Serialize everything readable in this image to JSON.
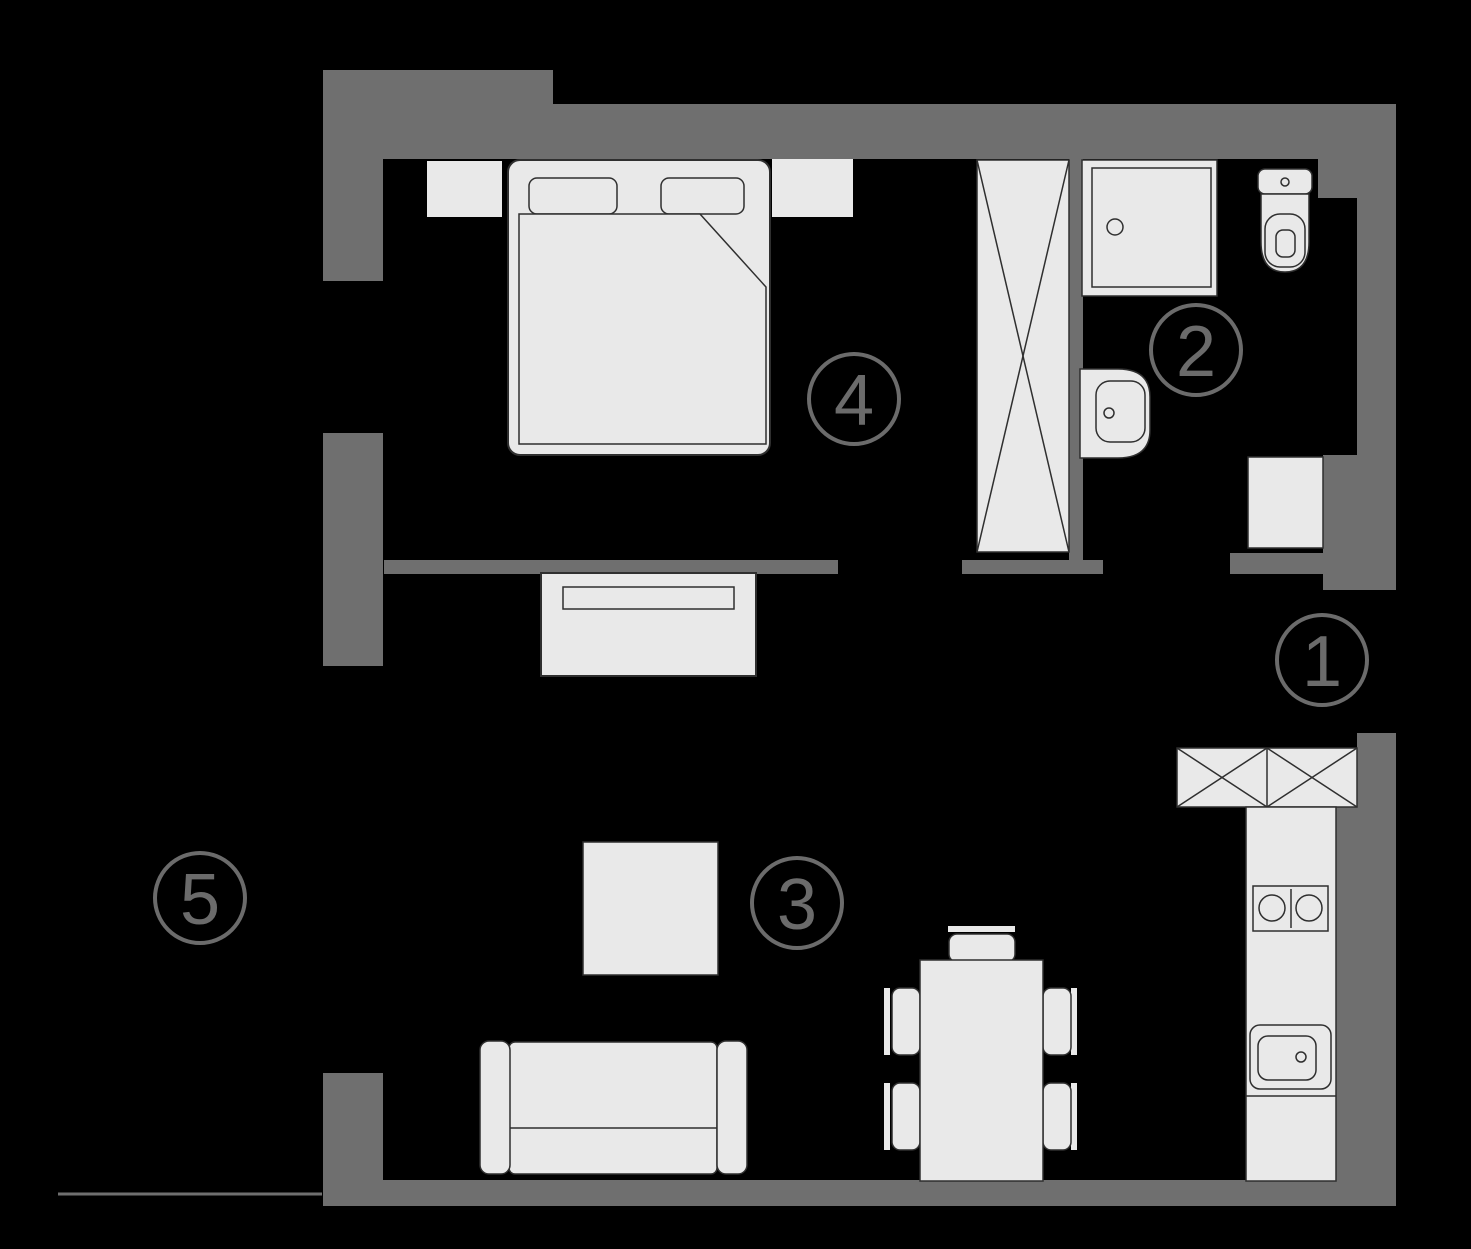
{
  "title": "Apartment floor plan",
  "colors": {
    "background": "#000000",
    "wall": "#6f6f6f",
    "furniture_fill": "#e9e9e9",
    "furniture_outline": "#2f2f2f",
    "marker": "#6b6b6b"
  },
  "rooms": [
    {
      "number": "1"
    },
    {
      "number": "2"
    },
    {
      "number": "3"
    },
    {
      "number": "4"
    },
    {
      "number": "5"
    }
  ]
}
